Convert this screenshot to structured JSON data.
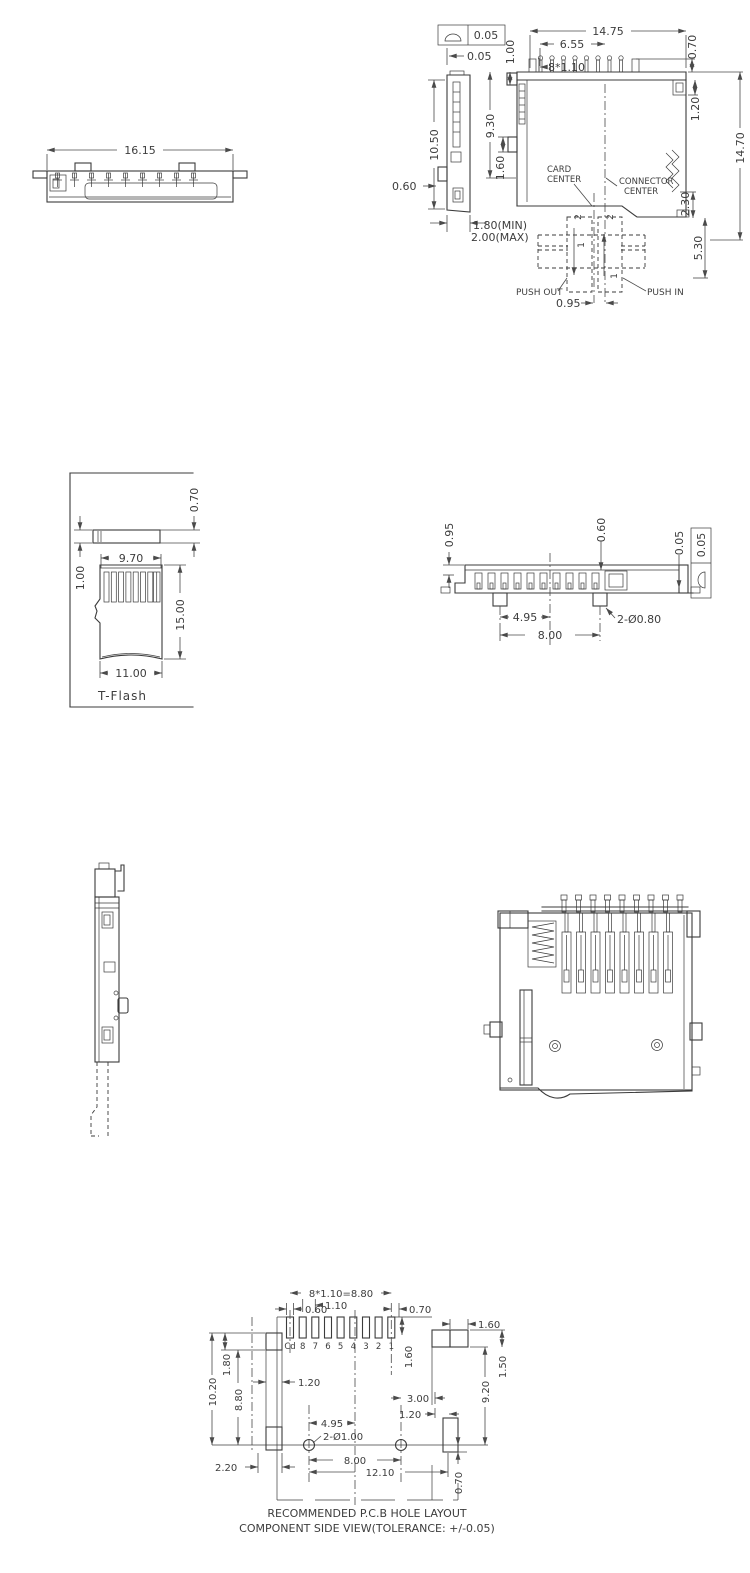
{
  "front": {
    "w1615": "16.15"
  },
  "side": {
    "tol": "0.05",
    "d005": "0.05",
    "d1050": "10.50",
    "d060": "0.60",
    "d180": "1.80(MIN)",
    "d200": "2.00(MAX)",
    "d100": "1.00",
    "d1475": "14.75",
    "d655": "6.55",
    "d8110": "8*1.10",
    "d070": "0.70",
    "d930": "9.30",
    "d160": "1.60",
    "d120": "1.20",
    "d1470": "14.70",
    "d230": "2.30",
    "d530": "5.30",
    "card1": "CARD",
    "card2": "CENTER",
    "conn1": "CONNECTOR",
    "conn2": "CENTER",
    "push_out": "PUSH OUT",
    "push_in": "PUSH IN",
    "d095": "0.95",
    "s2": "2",
    "s1": "1"
  },
  "tflash": {
    "d070": "0.70",
    "d100": "1.00",
    "d970": "9.70",
    "d1500": "15.00",
    "d1100": "11.00",
    "label": "T-Flash"
  },
  "bottom": {
    "d095": "0.95",
    "d060": "0.60",
    "d005": "0.05",
    "tol": "0.05",
    "d495": "4.95",
    "d800": "8.00",
    "holes": "2-Ø0.80"
  },
  "pcb": {
    "d060": "0.60",
    "pitch": "8*1.10=8.80",
    "d110": "1.10",
    "d070": "0.70",
    "d160a": "1.60",
    "d160b": "1.60",
    "d1020": "10.20",
    "d180": "1.80",
    "d880": "8.80",
    "d120a": "1.20",
    "d220": "2.20",
    "d495": "4.95",
    "holes": "2-Ø1.00",
    "d800": "8.00",
    "d1210": "12.10",
    "d300": "3.00",
    "d120b": "1.20",
    "d150": "1.50",
    "d920": "9.20",
    "d070b": "0.70",
    "pins": [
      "Cd",
      "8",
      "7",
      "6",
      "5",
      "4",
      "3",
      "2",
      "1"
    ],
    "title1": "RECOMMENDED  P.C.B  HOLE  LAYOUT",
    "title2": "COMPONENT  SIDE  VIEW(TOLERANCE:  +/-0.05)"
  }
}
